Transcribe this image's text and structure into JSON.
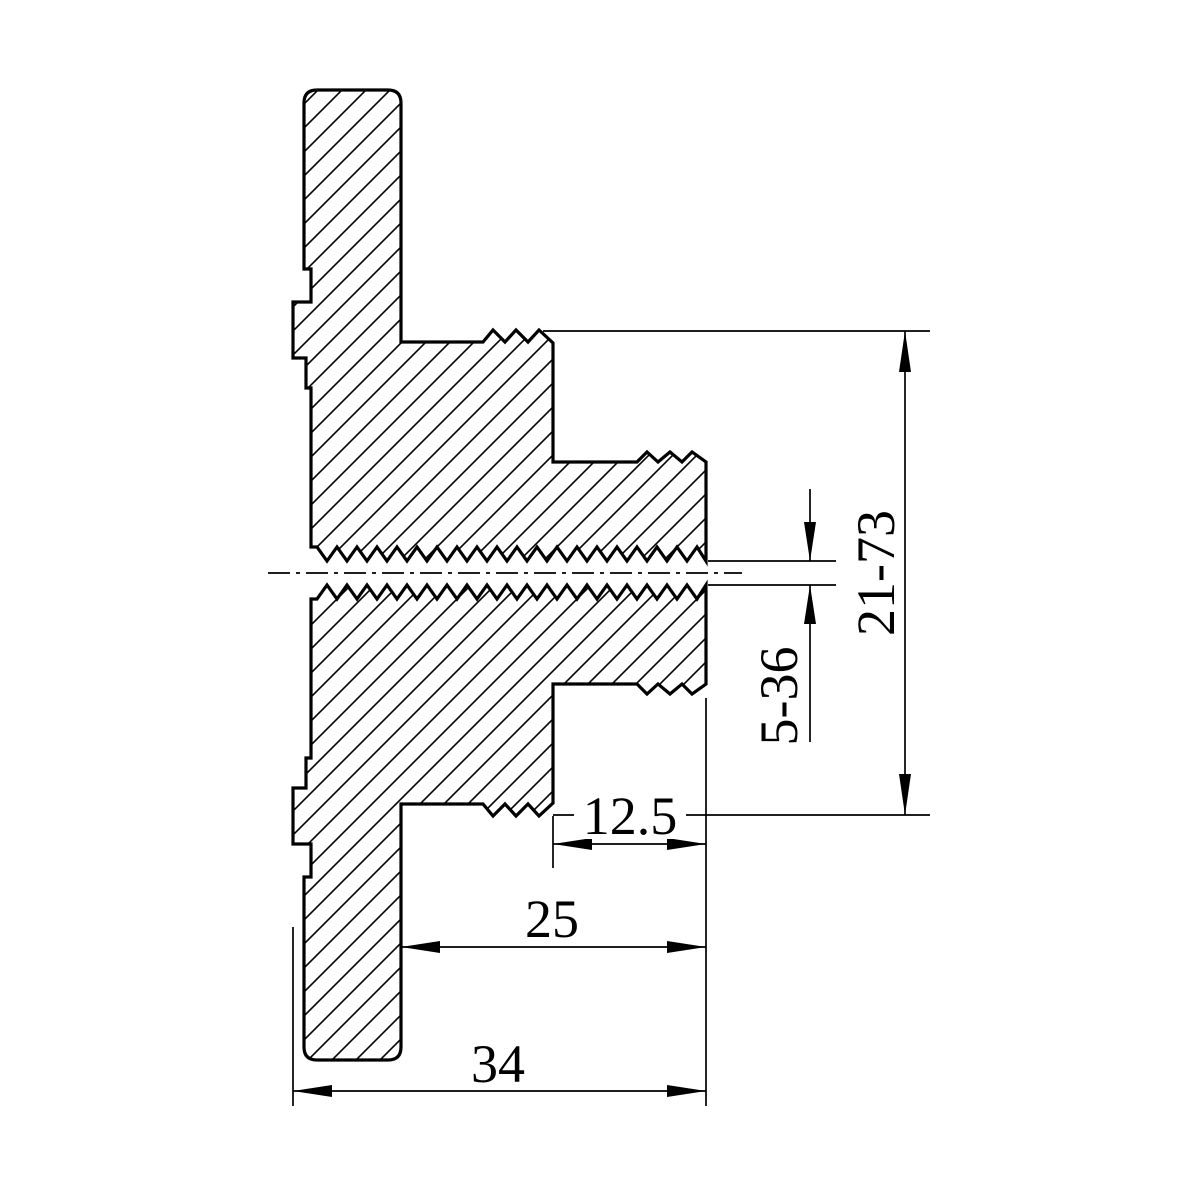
{
  "drawing": {
    "kind": "technical-cross-section",
    "background_color": "#ffffff",
    "line_color": "#000000",
    "dimensions": {
      "vertical_range": {
        "label": "21-73",
        "orientation": "vertical"
      },
      "bore_range": {
        "label": "5-36",
        "orientation": "vertical"
      },
      "boss_depth": {
        "label": "12.5",
        "orientation": "horizontal"
      },
      "hub_depth": {
        "label": "25",
        "orientation": "horizontal"
      },
      "overall_depth": {
        "label": "34",
        "orientation": "horizontal"
      }
    }
  }
}
